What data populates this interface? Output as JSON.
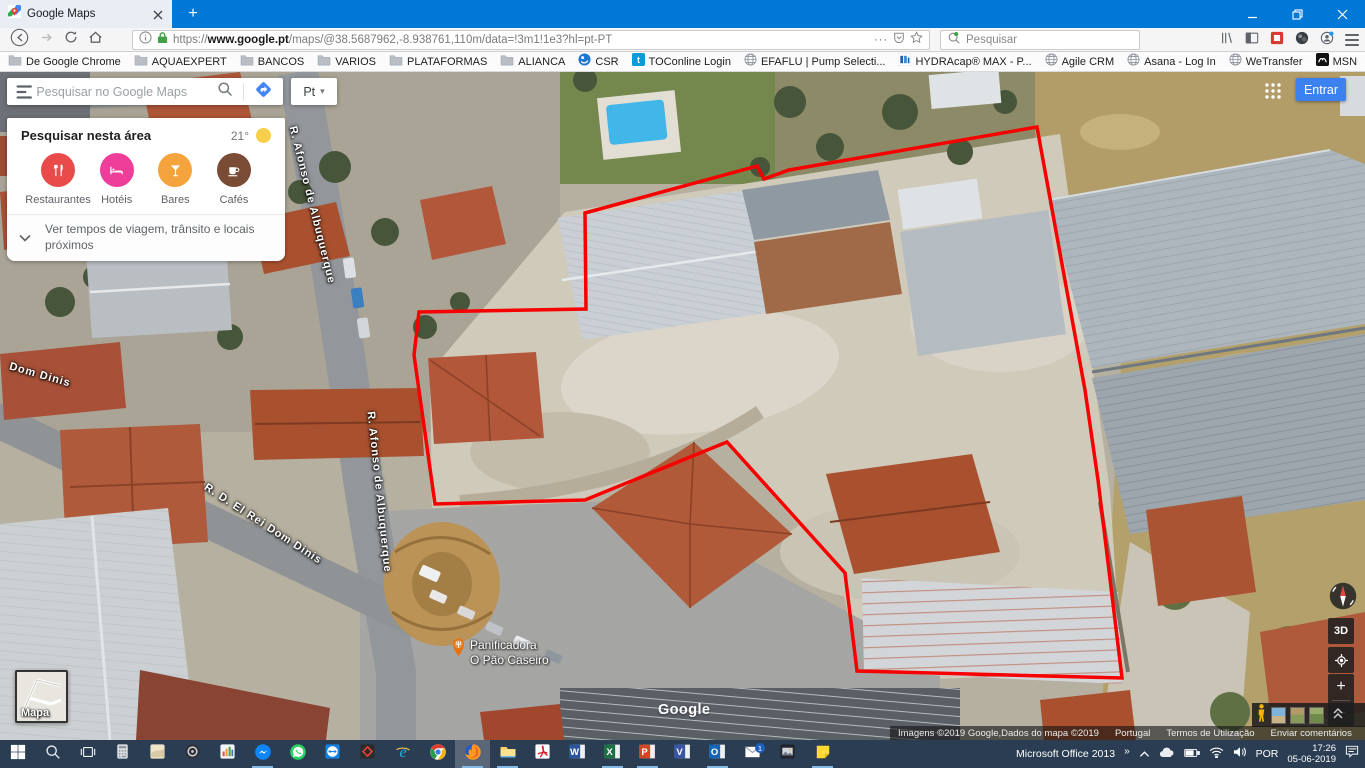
{
  "browser": {
    "tab_title": "Google Maps",
    "url": {
      "scheme": "https://",
      "domain": "www.google.pt",
      "path": "/maps/@38.5687962,-8.938761,110m/data=!3m1!1e3?hl=pt-PT"
    },
    "search_placeholder": "Pesquisar",
    "bookmarks": [
      {
        "label": "De Google Chrome",
        "icon": "folder"
      },
      {
        "label": "AQUAEXPERT",
        "icon": "folder"
      },
      {
        "label": "BANCOS",
        "icon": "folder"
      },
      {
        "label": "VARIOS",
        "icon": "folder"
      },
      {
        "label": "PLATAFORMAS",
        "icon": "folder"
      },
      {
        "label": "ALIANCA",
        "icon": "folder"
      },
      {
        "label": "CSR",
        "icon": "csr"
      },
      {
        "label": "TOConline Login",
        "icon": "toconline"
      },
      {
        "label": "EFAFLU | Pump Selecti...",
        "icon": "globe"
      },
      {
        "label": "HYDRAcap® MAX - P...",
        "icon": "hydracap"
      },
      {
        "label": "Agile CRM",
        "icon": "globe"
      },
      {
        "label": "Asana - Log In",
        "icon": "globe"
      },
      {
        "label": "WeTransfer",
        "icon": "globe"
      },
      {
        "label": "MSN",
        "icon": "msn"
      },
      {
        "label": "Facebook",
        "icon": "facebook"
      },
      {
        "label": "Login - MagniFinance",
        "icon": "magnifinance"
      },
      {
        "label": "Grundfos - PVP2019",
        "icon": "grundfos"
      },
      {
        "label": "Via Verde",
        "icon": "globe"
      }
    ]
  },
  "icons": {
    "new_tab": "+",
    "url_more": "···",
    "bookmarks_overflow": "»",
    "tray_overflow": "»",
    "lang_caret": "▾"
  },
  "maps": {
    "search_placeholder": "Pesquisar no Google Maps",
    "lang": "Pt",
    "signin": "Entrar",
    "area_panel": {
      "title": "Pesquisar nesta área",
      "temperature": "21°",
      "categories": [
        {
          "label": "Restaurantes",
          "color": "#e94b4b",
          "icon": "restaurant"
        },
        {
          "label": "Hotéis",
          "color": "#ef3e9a",
          "icon": "hotel"
        },
        {
          "label": "Bares",
          "color": "#f5a33c",
          "icon": "bar"
        },
        {
          "label": "Cafés",
          "color": "#7a4b35",
          "icon": "cafe"
        }
      ],
      "more": "Ver tempos de viagem, trânsito e locais próximos"
    },
    "controls": {
      "view3d": "3D",
      "map_thumb_label": "Mapa"
    },
    "street_labels": [
      {
        "text": "Dom Dinis",
        "x": 40,
        "y": 303,
        "rot": 16
      },
      {
        "text": "R. Afonso de Albuquerque",
        "x": 312,
        "y": 133,
        "rot": 76
      },
      {
        "text": "R. Afonso de Albuquerque",
        "x": 379,
        "y": 420,
        "rot": 84
      },
      {
        "text": "R. D. El Rei Dom Dinis",
        "x": 263,
        "y": 452,
        "rot": 33
      }
    ],
    "poi": {
      "line1": "Panificadora",
      "line2": "O Pão Caseiro"
    },
    "watermark": "Google",
    "attribution": {
      "imagery": "Imagens ©2019 Google,Dados do mapa ©2019",
      "region": "Portugal",
      "terms": "Termos de Utilização",
      "feedback": "Enviar comentários",
      "scale": "10 m"
    },
    "overlay_polygon": {
      "color": "#f70000",
      "points": [
        [
          585,
          141
        ],
        [
          757,
          94
        ],
        [
          764,
          107
        ],
        [
          789,
          98
        ],
        [
          1037,
          55
        ],
        [
          1085,
          318
        ],
        [
          1098,
          408
        ],
        [
          1122,
          606
        ],
        [
          857,
          599
        ],
        [
          845,
          501
        ],
        [
          727,
          370
        ],
        [
          585,
          428
        ],
        [
          435,
          432
        ],
        [
          414,
          283
        ],
        [
          419,
          240
        ],
        [
          586,
          237
        ]
      ]
    }
  },
  "taskbar": {
    "apps": [
      {
        "id": "start"
      },
      {
        "id": "search"
      },
      {
        "id": "task-view"
      },
      {
        "id": "calculator"
      },
      {
        "id": "photos"
      },
      {
        "id": "disc-app"
      },
      {
        "id": "equalizer-app"
      },
      {
        "id": "messenger",
        "open": true
      },
      {
        "id": "whatsapp"
      },
      {
        "id": "teamviewer"
      },
      {
        "id": "anydesk"
      },
      {
        "id": "internet-explorer"
      },
      {
        "id": "chrome"
      },
      {
        "id": "firefox",
        "active": true
      },
      {
        "id": "file-explorer",
        "open": true
      },
      {
        "id": "acrobat"
      },
      {
        "id": "word"
      },
      {
        "id": "excel",
        "open": true
      },
      {
        "id": "powerpoint",
        "open": true
      },
      {
        "id": "visio"
      },
      {
        "id": "outlook",
        "open": true
      },
      {
        "id": "mail",
        "badge": "1"
      },
      {
        "id": "movies"
      },
      {
        "id": "sticky-notes",
        "open": true
      }
    ],
    "tray": {
      "office": "Microsoft Office 2013",
      "lang": "POR",
      "time": "17:26",
      "date": "05-06-2019"
    }
  }
}
